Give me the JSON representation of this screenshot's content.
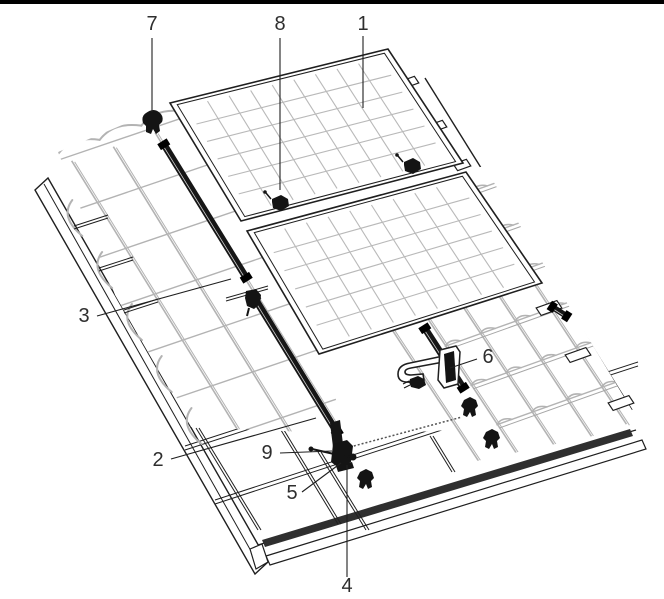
{
  "figure": {
    "description": "Technical line-art installation diagram of a solar panel mounting system on a pitched tile roof, with numbered callouts 1-9",
    "background_color": "#ffffff",
    "line_color": "#1f1f1f",
    "tile_line_color": "#b3b3b3",
    "hardware_color": "#141414",
    "label_color": "#2e2e2e",
    "top_border_color": "#000000"
  },
  "callouts": [
    {
      "number": "1"
    },
    {
      "number": "2"
    },
    {
      "number": "3"
    },
    {
      "number": "4"
    },
    {
      "number": "5"
    },
    {
      "number": "6"
    },
    {
      "number": "7"
    },
    {
      "number": "8"
    },
    {
      "number": "9"
    }
  ]
}
